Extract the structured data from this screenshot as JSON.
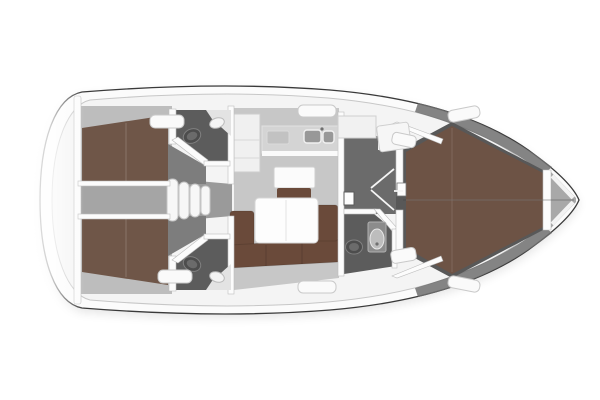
{
  "diagram": {
    "type": "floor-plan",
    "subject": "sailing-yacht-interior-top-view",
    "orientation": "bow-right",
    "visible_text": "",
    "areas": [
      "swim-platform",
      "aft-cabin-port",
      "aft-cabin-starboard",
      "engine-compartment",
      "companionway-steps",
      "aft-head-port",
      "aft-head-starboard",
      "galley",
      "nav-table",
      "saloon-dinette",
      "saloon-table",
      "corridor",
      "forward-head",
      "wardrobe-cabinet",
      "forward-cabin-v-berth",
      "anchor-locker"
    ],
    "fixtures": [
      "toilet",
      "washbasin",
      "double-sink",
      "stove",
      "mast-step",
      "deck-hatch",
      "berth-cushion",
      "sofa-cushion",
      "folding-door-marks"
    ]
  },
  "colors": {
    "page_bg": "#ffffff",
    "hull_line": "#3a3a3a",
    "hull_fill": "#fbfbfb",
    "deck_fill": "#f4f4f4",
    "deck_edge": "#c7c7c7",
    "bulwark_dark": "#6e6e6e",
    "sole": "#c7c7c7",
    "sole_mid": "#bdbdbd",
    "sole_dark": "#7d7d7d",
    "corridor_floor": "#6b6b6b",
    "head_floor": "#5c5c5c",
    "fwd_sole": "#585858",
    "engine": "#a5a5a5",
    "stepwell": "#9a9a9a",
    "berth": "#6f5648",
    "berth_fwd": "#6d5345",
    "sofa": "#6a4a3a",
    "wall": "#fcfcfc",
    "wall_edge": "#bdbdbd",
    "counter": "#d4d4d4",
    "fixture_dark": "#4d4d4d",
    "fixture_mid": "#8c8c8c",
    "white_top": "#fbfbfb",
    "hatch": "#fafafa",
    "locker": "#a8a8a8",
    "shadow": "#000000"
  }
}
